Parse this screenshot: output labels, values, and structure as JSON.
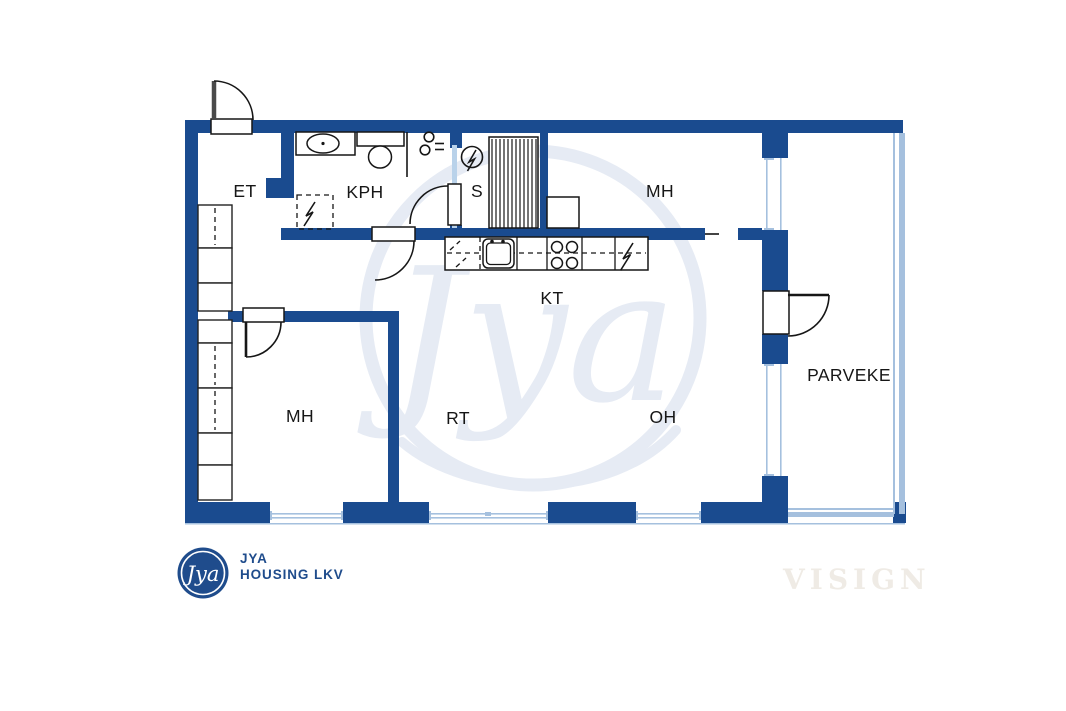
{
  "rooms": {
    "et": "ET",
    "kph": "KPH",
    "sauna": "S",
    "mh_top": "MH",
    "kt": "KT",
    "mh_left": "MH",
    "rt": "RT",
    "oh": "OH",
    "parveke": "PARVEKE"
  },
  "watermark": {
    "script": "Jya",
    "studio": "VISIGN"
  },
  "branding": {
    "badge_script": "Jya",
    "name_line1": "JYA",
    "name_line2": "HOUSING LKV"
  },
  "symbols": {
    "sauna_stove": "circle-zigzag",
    "sauna_benches": "vertical-stripes",
    "washing_machine": "dashed-box-zigzag",
    "dishwasher": "dashed-box-diagonals",
    "fridge": "zigzag-bolt",
    "stove": "four-burners",
    "kitchen_sink": "rounded-basin-two-taps",
    "washbasin": "oval-in-counter",
    "toilet": "tank-and-bowl",
    "coat_hook": "double-loop-ticks"
  },
  "colors": {
    "wall": "#1a4b8f",
    "window": "#a5c0de",
    "glass": "#b9d2ea",
    "ink": "#161616",
    "watermark": "#e6ebf4",
    "logo": "#1f4c8c",
    "visign": "#efebe5",
    "background": "#ffffff"
  }
}
